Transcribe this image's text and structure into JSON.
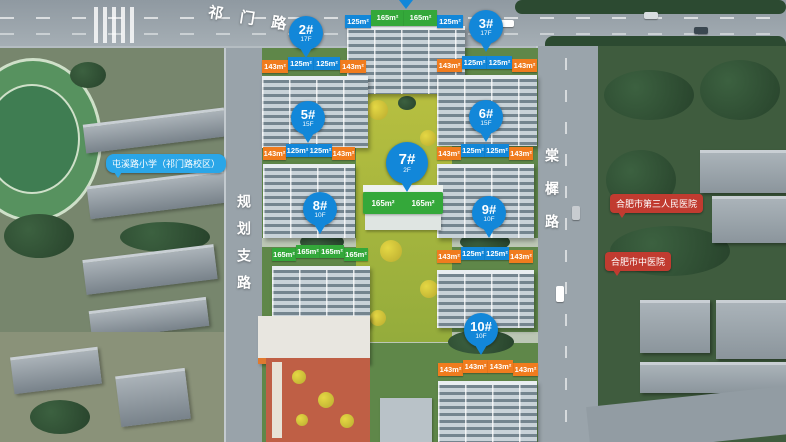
{
  "map": {
    "roads": {
      "top": "祁门路",
      "left": "规划支路",
      "right": "棠樨路"
    },
    "pois": {
      "school": "屯溪路小学（祁门路校区）",
      "hospital_1": "合肥市第三人民医院",
      "hospital_2": "合肥市中医院"
    },
    "buildings": {
      "top": {
        "units": [
          "125m²",
          "165m²",
          "165m²",
          "125m²"
        ]
      },
      "b2": {
        "pin": "2#",
        "floors": "17F",
        "units": [
          "143m²",
          "125m²",
          "125m²",
          "143m²"
        ]
      },
      "b3": {
        "pin": "3#",
        "floors": "17F",
        "units": [
          "143m²",
          "125m²",
          "125m²",
          "143m²"
        ]
      },
      "b5": {
        "pin": "5#",
        "floors": "15F",
        "units": [
          "143m²",
          "125m²",
          "125m²",
          "143m²"
        ]
      },
      "b6": {
        "pin": "6#",
        "floors": "15F",
        "units": [
          "143m²",
          "125m²",
          "125m²",
          "143m²"
        ]
      },
      "b7": {
        "pin": "7#",
        "floors": "2F",
        "units": [
          "165m²",
          "165m²"
        ]
      },
      "b8": {
        "pin": "8#",
        "floors": "10F",
        "units": [
          "165m²",
          "165m²",
          "165m²",
          "165m²"
        ]
      },
      "b9": {
        "pin": "9#",
        "floors": "10F",
        "units": [
          "143m²",
          "125m²",
          "125m²",
          "143m²"
        ]
      },
      "b10": {
        "pin": "10#",
        "floors": "10F",
        "units": [
          "143m²",
          "143m²",
          "143m²",
          "143m²"
        ]
      }
    },
    "colors": {
      "pin_blue": "#1287d9",
      "tag_blue": "#1287d9",
      "tag_orange": "#f07c1e",
      "tag_green": "#34a83a",
      "poi_school_bg": "#2aa6e8",
      "poi_hospital_bg": "#c13b30"
    }
  }
}
